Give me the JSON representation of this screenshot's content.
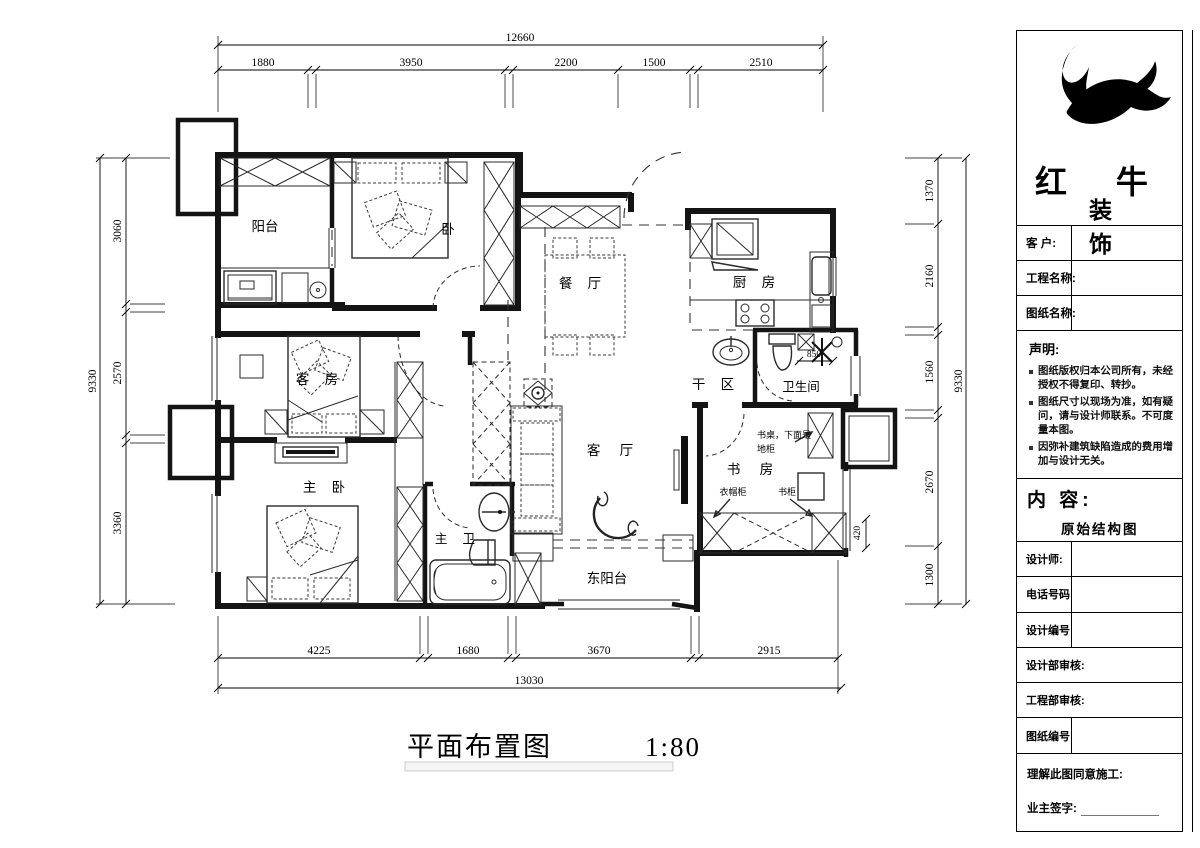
{
  "plan": {
    "rooms": {
      "balcony": "阳台",
      "bedroom": "卧",
      "dining": "餐 厅",
      "kitchen": "厨 房",
      "dry_area": "干 区",
      "bath": "卫生间",
      "guest": "客 房",
      "master": "主 卧",
      "master_bath": "主 卫",
      "living": "客 厅",
      "study": "书 房",
      "east_balcony": "东阳台"
    },
    "annotations": {
      "desk_line1": "书桌，下面是",
      "desk_line2": "地柜",
      "wardrobe": "衣帽柜",
      "bookcase": "书柜"
    },
    "inline_dims": {
      "bath_width": "850",
      "study_sill": "420"
    }
  },
  "dims": {
    "top": {
      "total": "12660",
      "segments": [
        "1880",
        "3950",
        "2200",
        "1500",
        "2510"
      ]
    },
    "bottom": {
      "total": "13030",
      "segments": [
        "4225",
        "1680",
        "3670",
        "2915"
      ]
    },
    "left": {
      "total": "9330",
      "segments": [
        "3060",
        "2570",
        "3360"
      ]
    },
    "right": {
      "total": "9330",
      "segments": [
        "1370",
        "2160",
        "1560",
        "2670",
        "1300"
      ]
    }
  },
  "footer": {
    "title": "平面布置图",
    "scale": "1:80"
  },
  "title_block": {
    "brand_line1": "红 牛",
    "brand_line2": "装 饰",
    "fields": [
      {
        "label": "客  户:"
      },
      {
        "label": "工程名称:"
      },
      {
        "label": "图纸名称:"
      }
    ],
    "statement": {
      "heading": "声明:",
      "items": [
        "图纸版权归本公司所有，未经授权不得复印、转抄。",
        "图纸尺寸以现场为准，如有疑问，请与设计师联系。不可度量本图。",
        "因弥补建筑缺陷造成的费用增加与设计无关。"
      ]
    },
    "content": {
      "label": "内 容:",
      "value": "原始结构图"
    },
    "rows": [
      {
        "label": "设计师:"
      },
      {
        "label": "电话号码"
      },
      {
        "label": "设计编号"
      },
      {
        "label": "设计部审核:"
      },
      {
        "label": "工程部审核:"
      },
      {
        "label": "图纸编号"
      }
    ],
    "footer": {
      "line1": "理解此图同意施工:",
      "line2": "业主签字:"
    }
  }
}
